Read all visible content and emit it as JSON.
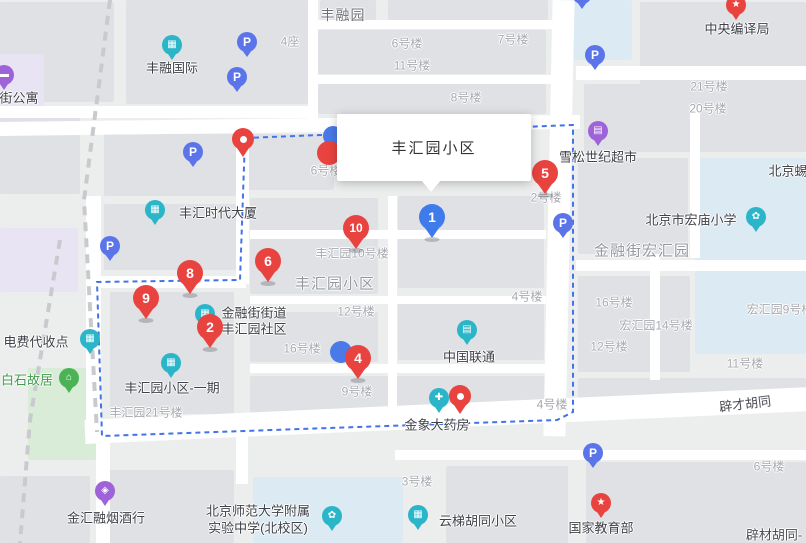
{
  "info_window": {
    "title": "丰汇园小区"
  },
  "parking_letter": "P",
  "colors": {
    "marker_red": "#e8433f",
    "marker_blue": "#3f7bea",
    "parking_blue": "#5b74ea",
    "poi_teal": "#2ab5c8",
    "poi_purple": "#9e63d8",
    "poi_green": "#4cb256",
    "boundary_blue": "#4273e8",
    "school_block": "#dcebf3",
    "park_block": "#d9ecd7"
  },
  "boundary": {
    "points": "245,138 573,125 573,412 557,420 102,436 97,282 240,280 245,138"
  },
  "decor_dashes": [
    {
      "pts": "110,0 84,200 97,432"
    },
    {
      "pts": "60,240 30,420 20,543"
    }
  ],
  "markers": {
    "numbered": [
      {
        "n": "1",
        "x": 432,
        "y": 240,
        "c": "blue"
      },
      {
        "n": "2",
        "x": 210,
        "y": 350,
        "c": "red"
      },
      {
        "n": "4",
        "x": 358,
        "y": 381,
        "c": "red"
      },
      {
        "n": "5",
        "x": 545,
        "y": 196,
        "c": "red"
      },
      {
        "n": "6",
        "x": 268,
        "y": 284,
        "c": "red"
      },
      {
        "n": "8",
        "x": 190,
        "y": 296,
        "c": "red"
      },
      {
        "n": "9",
        "x": 146,
        "y": 321,
        "c": "red"
      },
      {
        "n": "10",
        "x": 356,
        "y": 251,
        "c": "red"
      }
    ],
    "pins": [
      {
        "x": 243,
        "y": 157
      },
      {
        "x": 460,
        "y": 414
      }
    ],
    "parking": [
      {
        "x": 247,
        "y": 58
      },
      {
        "x": 237,
        "y": 93
      },
      {
        "x": 193,
        "y": 168
      },
      {
        "x": 595,
        "y": 71
      },
      {
        "x": 110,
        "y": 262
      },
      {
        "x": 563,
        "y": 239
      },
      {
        "x": 593,
        "y": 469
      },
      {
        "x": 582,
        "y": 10
      }
    ],
    "hidden_partials": [
      {
        "x": 333,
        "y": 136,
        "r": 10,
        "c": "#4a79e8"
      },
      {
        "x": 329,
        "y": 153,
        "r": 12,
        "c": "#e8433f"
      },
      {
        "x": 341,
        "y": 352,
        "r": 11,
        "c": "#4a79e8"
      }
    ]
  },
  "poi_icons": [
    {
      "g": "▦",
      "c": "teal",
      "x": 172,
      "y": 45,
      "name": "fengrong-international-icon"
    },
    {
      "g": "▬",
      "c": "purple",
      "x": 4,
      "y": 75,
      "name": "apartment-icon"
    },
    {
      "g": "★",
      "c": "red",
      "x": 736,
      "y": 5,
      "name": "central-compilation-bureau-icon"
    },
    {
      "g": "▤",
      "c": "purple",
      "x": 598,
      "y": 131,
      "name": "xuesong-supermarket-icon"
    },
    {
      "g": "▦",
      "c": "teal",
      "x": 155,
      "y": 210,
      "name": "fenghui-times-tower-icon"
    },
    {
      "g": "✿",
      "c": "teal",
      "x": 756,
      "y": 217,
      "name": "hongmiao-primary-school-icon"
    },
    {
      "g": "▦",
      "c": "teal",
      "x": 90,
      "y": 339,
      "name": "electric-fee-collection-icon"
    },
    {
      "g": "▦",
      "c": "teal",
      "x": 205,
      "y": 314,
      "name": "community-office-icon"
    },
    {
      "g": "⌂",
      "c": "green",
      "x": 69,
      "y": 378,
      "name": "baishi-residence-icon"
    },
    {
      "g": "▦",
      "c": "teal",
      "x": 171,
      "y": 363,
      "name": "fenghuiyuan-phase1-icon"
    },
    {
      "g": "▤",
      "c": "teal",
      "x": 467,
      "y": 330,
      "name": "china-unicom-icon"
    },
    {
      "g": "✚",
      "c": "teal",
      "x": 439,
      "y": 398,
      "name": "jinxiang-pharmacy-icon"
    },
    {
      "g": "◈",
      "c": "purple",
      "x": 105,
      "y": 491,
      "name": "jinhui-tobacco-shop-icon"
    },
    {
      "g": "✿",
      "c": "teal",
      "x": 332,
      "y": 516,
      "name": "experimental-school-icon"
    },
    {
      "g": "▦",
      "c": "teal",
      "x": 418,
      "y": 515,
      "name": "yunti-community-icon"
    },
    {
      "g": "★",
      "c": "red",
      "x": 601,
      "y": 503,
      "name": "education-ministry-icon"
    }
  ],
  "poi_labels": [
    {
      "t": "丰融国际",
      "x": 172,
      "y": 67
    },
    {
      "t": "街公寓",
      "x": 19,
      "y": 97
    },
    {
      "t": "中央编译局",
      "x": 737,
      "y": 28
    },
    {
      "t": "雪松世纪超市",
      "x": 598,
      "y": 156
    },
    {
      "t": "丰汇时代大厦",
      "x": 218,
      "y": 212
    },
    {
      "t": "北京市宏庙小学",
      "x": 691,
      "y": 219
    },
    {
      "t": "电费代收点",
      "x": 36,
      "y": 341
    },
    {
      "t": "金融街街道",
      "x": 254,
      "y": 312
    },
    {
      "t": "丰汇园社区",
      "x": 254,
      "y": 328
    },
    {
      "t": "白石故居",
      "x": 27,
      "y": 379,
      "c": "green"
    },
    {
      "t": "丰汇园小区-一期",
      "x": 172,
      "y": 387
    },
    {
      "t": "中国联通",
      "x": 469,
      "y": 356
    },
    {
      "t": "金象大药房",
      "x": 437,
      "y": 424
    },
    {
      "t": "金汇融烟酒行",
      "x": 106,
      "y": 517
    },
    {
      "t": "北京师范大学附属",
      "x": 258,
      "y": 510
    },
    {
      "t": "实验中学(北校区)",
      "x": 258,
      "y": 527
    },
    {
      "t": "云梯胡同小区",
      "x": 478,
      "y": 520
    },
    {
      "t": "国家教育部",
      "x": 601,
      "y": 527
    },
    {
      "t": "北京蜴",
      "x": 788,
      "y": 170
    }
  ],
  "building_labels": [
    {
      "t": "4座",
      "x": 290,
      "y": 41
    },
    {
      "t": "6号楼",
      "x": 407,
      "y": 43
    },
    {
      "t": "7号楼",
      "x": 513,
      "y": 39
    },
    {
      "t": "11号楼",
      "x": 412,
      "y": 65
    },
    {
      "t": "8号楼",
      "x": 466,
      "y": 97
    },
    {
      "t": "21号楼",
      "x": 709,
      "y": 86
    },
    {
      "t": "20号楼",
      "x": 708,
      "y": 108
    },
    {
      "t": "2号楼",
      "x": 546,
      "y": 197
    },
    {
      "t": "6号楼",
      "x": 326,
      "y": 170
    },
    {
      "t": "丰汇园10号楼",
      "x": 352,
      "y": 253
    },
    {
      "t": "12号楼",
      "x": 356,
      "y": 311
    },
    {
      "t": "16号楼",
      "x": 302,
      "y": 348
    },
    {
      "t": "4号楼",
      "x": 527,
      "y": 296
    },
    {
      "t": "16号楼",
      "x": 614,
      "y": 302
    },
    {
      "t": "宏汇园14号楼",
      "x": 656,
      "y": 325
    },
    {
      "t": "12号楼",
      "x": 609,
      "y": 346
    },
    {
      "t": "11号楼",
      "x": 745,
      "y": 363
    },
    {
      "t": "宏汇园9号楼",
      "x": 780,
      "y": 309
    },
    {
      "t": "9号楼",
      "x": 357,
      "y": 391
    },
    {
      "t": "4号楼",
      "x": 552,
      "y": 404
    },
    {
      "t": "6号楼",
      "x": 769,
      "y": 466
    },
    {
      "t": "3号楼",
      "x": 417,
      "y": 481
    },
    {
      "t": "丰汇园21号楼",
      "x": 146,
      "y": 412
    }
  ],
  "area_labels": [
    {
      "t": "丰融园",
      "x": 343,
      "y": 15,
      "cls": "dark"
    },
    {
      "t": "丰汇园小区",
      "x": 335,
      "y": 283
    },
    {
      "t": "金融街宏汇园",
      "x": 642,
      "y": 250
    }
  ],
  "street_labels": [
    {
      "t": "辟才胡同",
      "x": 745,
      "y": 403,
      "r": -7
    },
    {
      "t": "辟材胡同-",
      "x": 774,
      "y": 534,
      "r": 0
    }
  ],
  "blocks": [
    {
      "x": 0,
      "y": 2,
      "w": 114,
      "h": 100
    },
    {
      "x": 126,
      "y": 0,
      "w": 182,
      "h": 104
    },
    {
      "x": 320,
      "y": 0,
      "w": 56,
      "h": 20
    },
    {
      "x": 388,
      "y": 0,
      "w": 160,
      "h": 20
    },
    {
      "x": 318,
      "y": 30,
      "w": 228,
      "h": 44
    },
    {
      "x": 318,
      "y": 84,
      "w": 228,
      "h": 30
    },
    {
      "x": 640,
      "y": 2,
      "w": 166,
      "h": 104
    },
    {
      "x": 584,
      "y": 84,
      "w": 222,
      "h": 68
    },
    {
      "x": 560,
      "y": 0,
      "w": 72,
      "h": 60,
      "c": "#dcebf3"
    },
    {
      "x": 0,
      "y": 112,
      "w": 80,
      "h": 82
    },
    {
      "x": 0,
      "y": 54,
      "w": 44,
      "h": 52,
      "c": "#e9e4f4"
    },
    {
      "x": 0,
      "y": 228,
      "w": 78,
      "h": 64,
      "c": "#e9e4f4"
    },
    {
      "x": 104,
      "y": 134,
      "w": 132,
      "h": 62
    },
    {
      "x": 248,
      "y": 134,
      "w": 86,
      "h": 56
    },
    {
      "x": 104,
      "y": 204,
      "w": 132,
      "h": 66
    },
    {
      "x": 110,
      "y": 292,
      "w": 124,
      "h": 122
    },
    {
      "x": 250,
      "y": 198,
      "w": 128,
      "h": 96
    },
    {
      "x": 398,
      "y": 196,
      "w": 146,
      "h": 92
    },
    {
      "x": 250,
      "y": 312,
      "w": 128,
      "h": 50
    },
    {
      "x": 398,
      "y": 298,
      "w": 146,
      "h": 62
    },
    {
      "x": 250,
      "y": 376,
      "w": 296,
      "h": 38
    },
    {
      "x": 578,
      "y": 158,
      "w": 110,
      "h": 96
    },
    {
      "x": 695,
      "y": 158,
      "w": 111,
      "h": 196,
      "c": "#dcebf3"
    },
    {
      "x": 578,
      "y": 276,
      "w": 112,
      "h": 96
    },
    {
      "x": 578,
      "y": 378,
      "w": 228,
      "h": 28
    },
    {
      "x": 100,
      "y": 470,
      "w": 134,
      "h": 73
    },
    {
      "x": 0,
      "y": 476,
      "w": 90,
      "h": 67
    },
    {
      "x": 253,
      "y": 477,
      "w": 150,
      "h": 66,
      "c": "#dcebf3"
    },
    {
      "x": 446,
      "y": 466,
      "w": 122,
      "h": 77
    },
    {
      "x": 586,
      "y": 462,
      "w": 220,
      "h": 81
    },
    {
      "x": 28,
      "y": 368,
      "w": 68,
      "h": 92,
      "c": "#d9ecd7"
    }
  ],
  "roads": [
    {
      "x": 0,
      "y": 106,
      "w": 312,
      "h": 12
    },
    {
      "x": 0,
      "y": 122,
      "w": 580,
      "h": 14,
      "r": -0.7
    },
    {
      "x": 548,
      "y": 0,
      "w": 22,
      "h": 436,
      "r": 1.2
    },
    {
      "x": 85,
      "y": 420,
      "w": 725,
      "h": 24,
      "r": -2.6
    },
    {
      "x": 86,
      "y": 196,
      "w": 15,
      "h": 242
    },
    {
      "x": 88,
      "y": 276,
      "w": 158,
      "h": 12
    },
    {
      "x": 236,
      "y": 126,
      "w": 13,
      "h": 158
    },
    {
      "x": 576,
      "y": 66,
      "w": 230,
      "h": 14
    },
    {
      "x": 576,
      "y": 260,
      "w": 230,
      "h": 11
    },
    {
      "x": 308,
      "y": 0,
      "w": 10,
      "h": 122
    },
    {
      "x": 318,
      "y": 20,
      "w": 242,
      "h": 9
    },
    {
      "x": 318,
      "y": 75,
      "w": 242,
      "h": 9
    },
    {
      "x": 250,
      "y": 230,
      "w": 296,
      "h": 9
    },
    {
      "x": 388,
      "y": 196,
      "w": 9,
      "h": 228
    },
    {
      "x": 250,
      "y": 296,
      "w": 296,
      "h": 8
    },
    {
      "x": 250,
      "y": 364,
      "w": 296,
      "h": 9
    },
    {
      "x": 395,
      "y": 450,
      "w": 411,
      "h": 10
    },
    {
      "x": 96,
      "y": 432,
      "w": 14,
      "h": 111
    },
    {
      "x": 236,
      "y": 414,
      "w": 12,
      "h": 70
    },
    {
      "x": 650,
      "y": 254,
      "w": 10,
      "h": 126
    },
    {
      "x": 690,
      "y": 106,
      "w": 10,
      "h": 152
    }
  ]
}
